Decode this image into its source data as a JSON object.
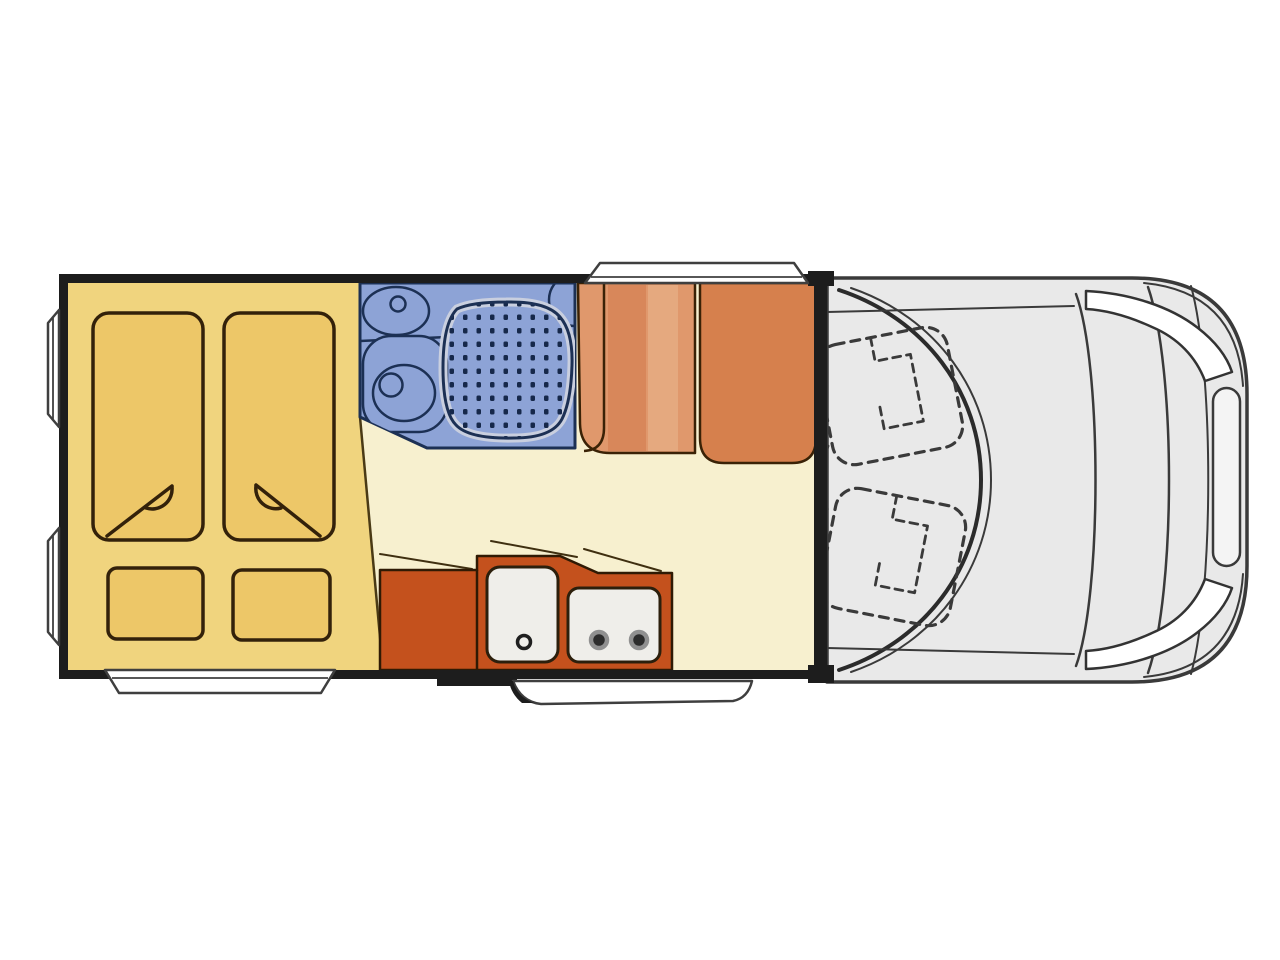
{
  "diagram": {
    "type": "motorhome-floorplan-top-view",
    "areas": [
      {
        "id": "rear-bedroom",
        "label": "twin-single-beds"
      },
      {
        "id": "washroom",
        "label": "shower-toilet-washbasin"
      },
      {
        "id": "dinette",
        "label": "two-upholstered-bench-seats"
      },
      {
        "id": "kitchen",
        "label": "sink-and-two-burner-hob"
      },
      {
        "id": "cab",
        "label": "driver-cab-with-two-swivel-seats"
      }
    ],
    "window_count": 4,
    "entry_step_count": 1
  },
  "colors": {
    "wall": "#1d1d1d",
    "floor_cream": "#f7f0cf",
    "bedroom_yellow": "#f0d47e",
    "bedding": "#edc768",
    "bath_blue": "#8da3d6",
    "shower_dot": "#16284a",
    "shower_ring": "#c9cfdf",
    "seat_left": "#e0986c",
    "seat_left_dark": "#d8875a",
    "seat_left_light": "#e5a97f",
    "seat_right": "#d6804d",
    "counter": "#c4511d",
    "appliance": "#efeeea",
    "burner": "#2c2c2c",
    "cab_body": "#e9e9e9",
    "grille": "#f4f4f4",
    "headlight": "#ffffff",
    "window": "#ffffff",
    "background": "#ffffff"
  }
}
